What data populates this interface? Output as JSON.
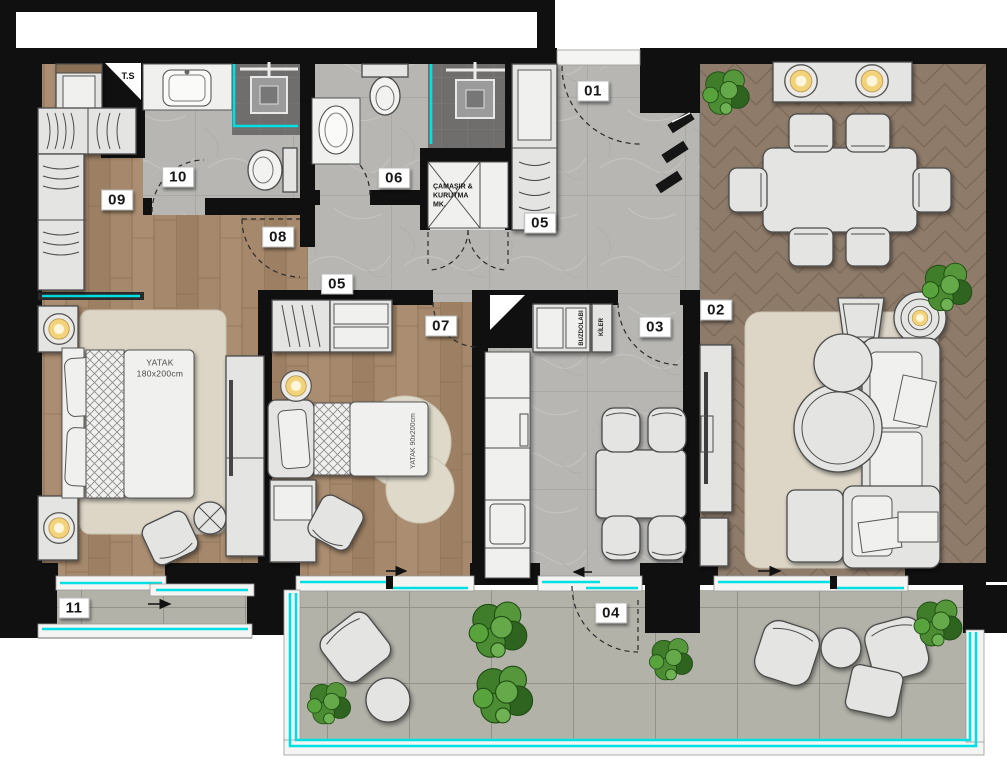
{
  "plan": {
    "type": "apartment-floor-plan",
    "room_labels": {
      "entry": "01",
      "living": "02",
      "kitchen": "03",
      "balcony_main": "04",
      "hall": "05",
      "hall2": "05",
      "bath_ensuite": "06",
      "bedroom_child": "07",
      "corridor": "08",
      "dressing": "09",
      "bath_main": "10",
      "balcony_small": "11"
    },
    "annotations": {
      "shaft": "T.S",
      "laundry": "ÇAMAŞIR &\nKURUTMA\nMK.",
      "bed_double": "YATAK\n180x200cm",
      "bed_single": "YATAK 90x200cm",
      "fridge": "BUZDOLABI",
      "pantry": "KİLER"
    },
    "colors": {
      "wall": "#111111",
      "glass": "#00dfe3",
      "wood_bedrooms": "#a6896c",
      "wood_living": "#8e7b6a",
      "tile_hall": "#b7b6b3",
      "tile_shower": "#6f6e6d",
      "paver_balcony": "#b3b2a9",
      "furniture": "#e4e4e2",
      "rug": "#ddd6c7",
      "plant_green": "#3f7d2a",
      "lamp_glow": "#f3d37a"
    }
  }
}
